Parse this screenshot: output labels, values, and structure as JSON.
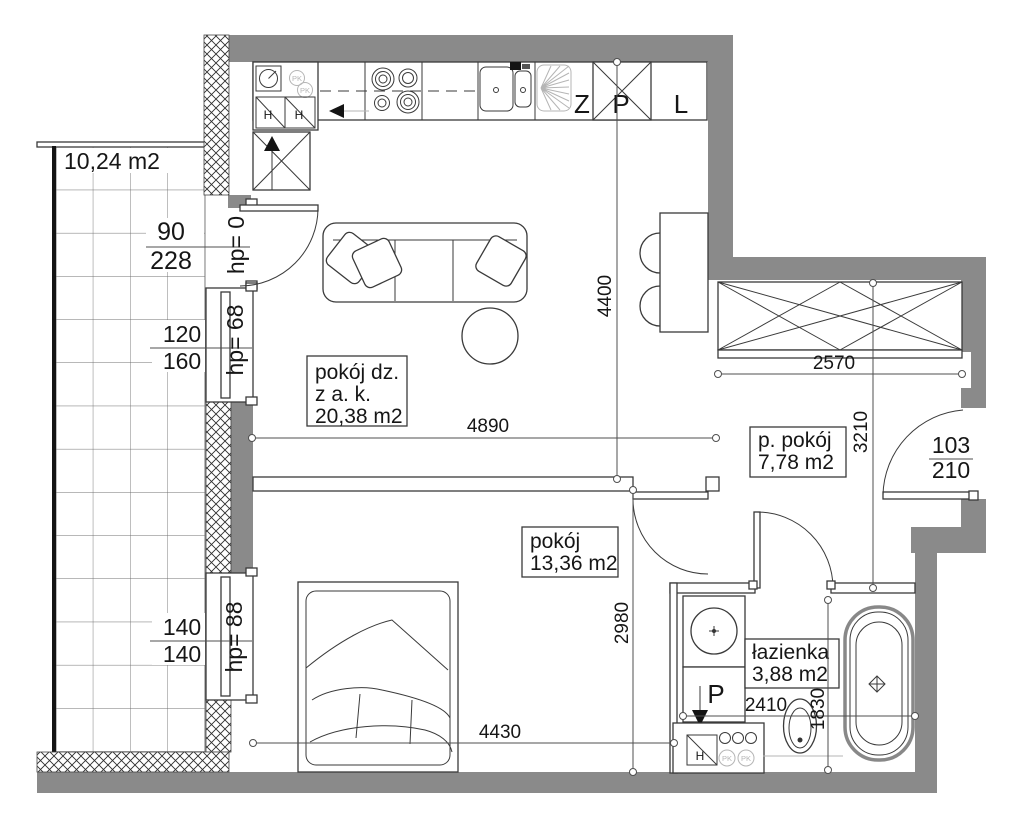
{
  "colors": {
    "wall": "#8a8a8a",
    "line": "#3a3a3a",
    "dimc": "#4f4f4f",
    "faint": "#b5b5b5"
  },
  "balcony": {
    "area": "10,24 m2"
  },
  "rooms": {
    "living": {
      "l1": "pokój dz.",
      "l2": "z a. k.",
      "l3": "20,38 m2"
    },
    "hall": {
      "l1": "p. pokój",
      "l2": "7,78 m2"
    },
    "bedroom": {
      "l1": "pokój",
      "l2": "13,36 m2"
    },
    "bathroom": {
      "l1": "łazienka",
      "l2": "3,88 m2"
    }
  },
  "kitchen": {
    "z": "Z",
    "p": "P",
    "l": "L",
    "h1": "H",
    "h2": "H",
    "pk1": "PK",
    "pk2": "PK"
  },
  "bath_items": {
    "washer": "P",
    "h": "H",
    "pk1": "PK",
    "pk2": "PK"
  },
  "dims": {
    "v4400": "4400",
    "h4890": "4890",
    "h2570": "2570",
    "v3210": "3210",
    "v2980": "2980",
    "h2410": "2410",
    "v1830": "1830",
    "h4430": "4430"
  },
  "openings": {
    "balcony_door": {
      "w": "90",
      "h": "228",
      "hp": "hp= 0"
    },
    "window_living": {
      "w": "120",
      "h": "160",
      "hp": "hp= 68"
    },
    "window_bedroom": {
      "w": "140",
      "h": "140",
      "hp": "hp= 88"
    },
    "entrance": {
      "w": "103",
      "h": "210"
    }
  }
}
